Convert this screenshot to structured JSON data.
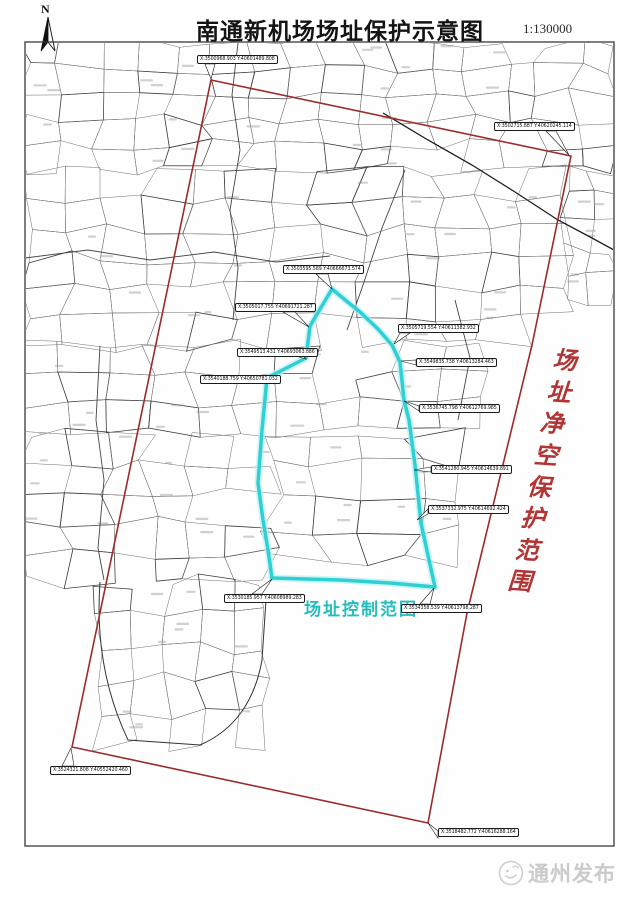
{
  "page": {
    "title": "南通新机场场址保护示意图",
    "scale": "1:130000",
    "north_label": "N",
    "watermark_text": "通州发布"
  },
  "map": {
    "frame": {
      "x": 25,
      "y": 42,
      "w": 589,
      "h": 804
    },
    "clearance_zone": {
      "label": "场址净空保护范围",
      "chars": [
        "场",
        "址",
        "净",
        "空",
        "保",
        "护",
        "范",
        "围"
      ],
      "char_positions": [
        [
          565,
          358
        ],
        [
          559,
          390
        ],
        [
          552,
          421
        ],
        [
          546,
          453
        ],
        [
          539,
          485
        ],
        [
          533,
          516
        ],
        [
          527,
          548
        ],
        [
          520,
          579
        ]
      ],
      "text_color": "#b23535",
      "boundary_color": "#9b2c2c",
      "boundary_points": [
        [
          211,
          80
        ],
        [
          571,
          156
        ],
        [
          532,
          345
        ],
        [
          467,
          613
        ],
        [
          428,
          823
        ],
        [
          72,
          747
        ]
      ]
    },
    "control_zone": {
      "label": "场址控制范围",
      "text_color": "#25bcbc",
      "boundary_color": "#2fd0d4",
      "boundary_glow": "#b9eff1",
      "boundary_points": [
        [
          332,
          289
        ],
        [
          310,
          326
        ],
        [
          306,
          358
        ],
        [
          267,
          378
        ],
        [
          262,
          430
        ],
        [
          258,
          483
        ],
        [
          263,
          520
        ],
        [
          268,
          550
        ],
        [
          272,
          578
        ],
        [
          340,
          580
        ],
        [
          390,
          583
        ],
        [
          435,
          587
        ],
        [
          429,
          560
        ],
        [
          421,
          523
        ],
        [
          415,
          465
        ],
        [
          409,
          420
        ],
        [
          404,
          400
        ],
        [
          400,
          362
        ],
        [
          392,
          345
        ],
        [
          378,
          329
        ],
        [
          360,
          312
        ],
        [
          344,
          299
        ]
      ]
    },
    "callouts": [
      {
        "group": "clearance",
        "text": "X:3500968.903  Y:40601489.808",
        "box": [
          197,
          55
        ],
        "tail": [
          [
            205,
            64
          ],
          [
            215,
            64
          ]
        ],
        "vertex": [
          211,
          79
        ]
      },
      {
        "group": "clearance",
        "text": "X:3502715.887  Y:40620245.114",
        "box": [
          494,
          122
        ],
        "tail": [
          [
            546,
            131
          ],
          [
            556,
            131
          ]
        ],
        "vertex": [
          569,
          155
        ]
      },
      {
        "group": "clearance",
        "text": "X:3524321.808  Y:40552420.460",
        "box": [
          50,
          766
        ],
        "tail": [
          [
            62,
            766
          ],
          [
            74,
            766
          ]
        ],
        "vertex": [
          71,
          748
        ]
      },
      {
        "group": "clearance",
        "text": "X:3518482.772  Y:40616288.164",
        "box": [
          438,
          828
        ],
        "tail": [
          [
            438,
            831
          ],
          [
            438,
            838
          ]
        ],
        "vertex": [
          428,
          823
        ]
      },
      {
        "group": "control",
        "text": "X:3503595.589  Y:40666673.574",
        "box": [
          283,
          265
        ],
        "tail": [
          [
            316,
            274
          ],
          [
            328,
            274
          ]
        ],
        "vertex": [
          332,
          289
        ]
      },
      {
        "group": "control",
        "text": "X:3505017.755  Y:40691721.287",
        "box": [
          235,
          303
        ],
        "tail": [
          [
            283,
            312
          ],
          [
            295,
            312
          ]
        ],
        "vertex": [
          309,
          327
        ]
      },
      {
        "group": "control",
        "text": "X:3549513.431  Y:40693063.886",
        "box": [
          237,
          348
        ],
        "tail": [
          [
            299,
            352
          ],
          [
            299,
            357
          ]
        ],
        "vertex": [
          306,
          359
        ]
      },
      {
        "group": "control",
        "text": "X:3540188.759  Y:40650781.032",
        "box": [
          200,
          375
        ],
        "tail": [
          [
            262,
            377
          ],
          [
            262,
            382
          ]
        ],
        "vertex": [
          267,
          379
        ]
      },
      {
        "group": "control",
        "text": "X:3505719.554  Y:40611382.932",
        "box": [
          398,
          324
        ],
        "tail": [
          [
            400,
            333
          ],
          [
            410,
            333
          ]
        ],
        "vertex": [
          394,
          344
        ]
      },
      {
        "group": "control",
        "text": "X:3549835.738  Y:40613284.463",
        "box": [
          416,
          358
        ],
        "tail": [
          [
            416,
            360
          ],
          [
            416,
            365
          ]
        ],
        "vertex": [
          401,
          361
        ]
      },
      {
        "group": "control",
        "text": "X:3536745.798  Y:40612769.985",
        "box": [
          419,
          404
        ],
        "tail": [
          [
            419,
            406
          ],
          [
            419,
            411
          ]
        ],
        "vertex": [
          404,
          401
        ]
      },
      {
        "group": "control",
        "text": "X:3541280.945  Y:40614639.891",
        "box": [
          431,
          465
        ],
        "tail": [
          [
            431,
            467
          ],
          [
            431,
            472
          ]
        ],
        "vertex": [
          414,
          470
        ]
      },
      {
        "group": "control",
        "text": "X:3537332.975  Y:40614692.424",
        "box": [
          428,
          505
        ],
        "tail": [
          [
            428,
            509
          ],
          [
            428,
            514
          ]
        ],
        "vertex": [
          417,
          520
        ]
      },
      {
        "group": "control",
        "text": "X:3530185.957  Y:40608989.283",
        "box": [
          224,
          594
        ],
        "tail": [
          [
            252,
            594
          ],
          [
            262,
            594
          ]
        ],
        "vertex": [
          272,
          579
        ]
      },
      {
        "group": "control",
        "text": "X:3534358.539  Y:40613798.287",
        "box": [
          401,
          604
        ],
        "tail": [
          [
            420,
            604
          ],
          [
            430,
            604
          ]
        ],
        "vertex": [
          434,
          588
        ]
      }
    ]
  }
}
